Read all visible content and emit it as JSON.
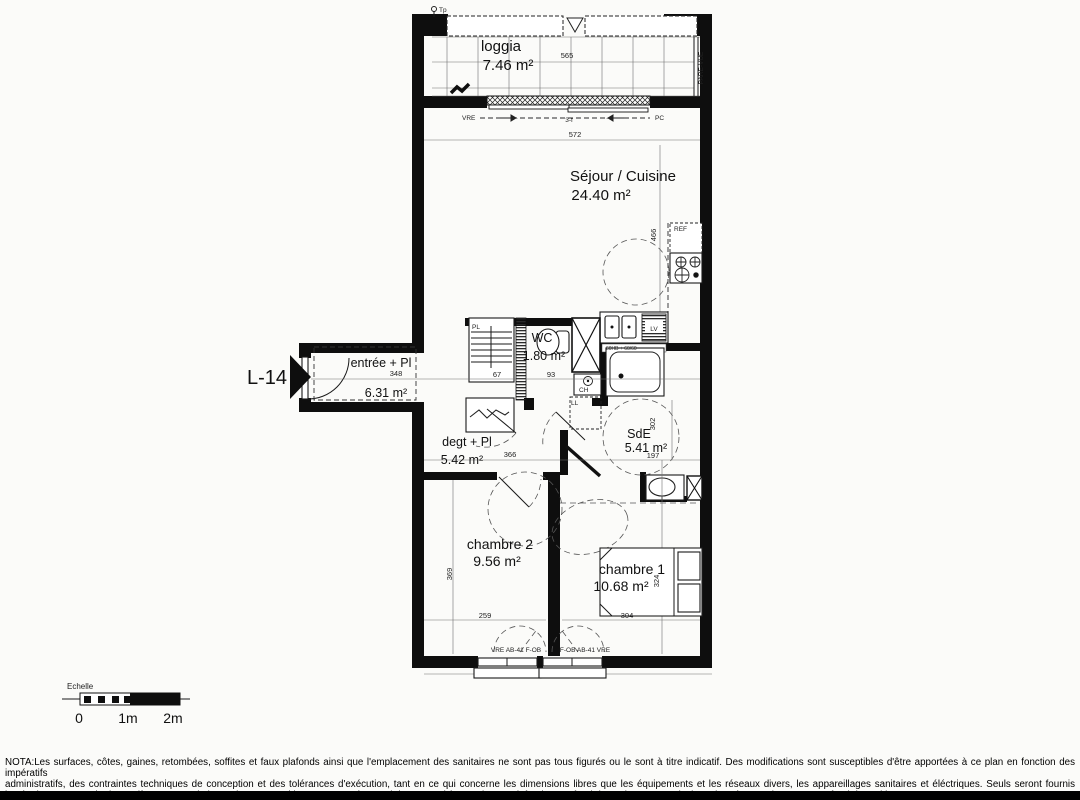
{
  "plan": {
    "labels": {
      "unit": "L-14",
      "tp": "Tp",
      "pare_vue": "PARE-VUE",
      "vre_top": "VRE",
      "pc_top": "PC",
      "sliding": "3-f",
      "ref": "REF",
      "lv": "LV",
      "pl": "PL",
      "ch": "CH",
      "ll": "LL",
      "sink_code": "60HB + 60/60",
      "window_left": "VRE  AB-41  F-OB",
      "window_right": "F-OB  AB-41  VRE"
    },
    "rooms": [
      {
        "name": "loggia",
        "area": "7.46 m²"
      },
      {
        "name": "Séjour / Cuisine",
        "area": "24.40 m²"
      },
      {
        "name": "entrée + Pl",
        "area": "6.31 m²"
      },
      {
        "name": "WC",
        "area": "1.80 m²"
      },
      {
        "name": "degt + Pl",
        "area": "5.42 m²"
      },
      {
        "name": "SdE",
        "area": "5.41 m²"
      },
      {
        "name": "chambre 2",
        "area": "9.56 m²"
      },
      {
        "name": "chambre 1",
        "area": "10.68 m²"
      }
    ],
    "dims": {
      "loggia": "565",
      "sejour": "572",
      "kitchen": "466",
      "entree": "348",
      "pl": "67",
      "wc": "93",
      "degt": "366",
      "sde_h": "302",
      "sde_w": "197",
      "ch2_h": "369",
      "ch2_w": "259",
      "ch1_h": "324",
      "ch1_w": "304"
    }
  },
  "scalebar": {
    "title": "Echelle",
    "t0": "0",
    "t1": "1m",
    "t2": "2m"
  },
  "nota": {
    "l1": "NOTA:Les surfaces, côtes, gaines, retombées, soffites et faux plafonds ainsi que l'emplacement des sanitaires ne sont pas tous figurés ou le sont à titre indicatif. Des modifications sont susceptibles d'être apportées à ce plan en fonction des impératifs",
    "l2": "administratifs, des contraintes techniques de conception et des tolérances d'exécution, tant en ce qui concerne les dimensions libres que les équipements  et les réseaux divers, les appareillages sanitaires et éléctriques. Seuls seront fournis",
    "l3": "les équipements sur le descrptif en annexe de l'acte de vente.Parking : Passage éventuel de tuyaux d'évacuation en plafond ou en fond de stationnement ainsi que la présence de cunette en fond de parking."
  }
}
